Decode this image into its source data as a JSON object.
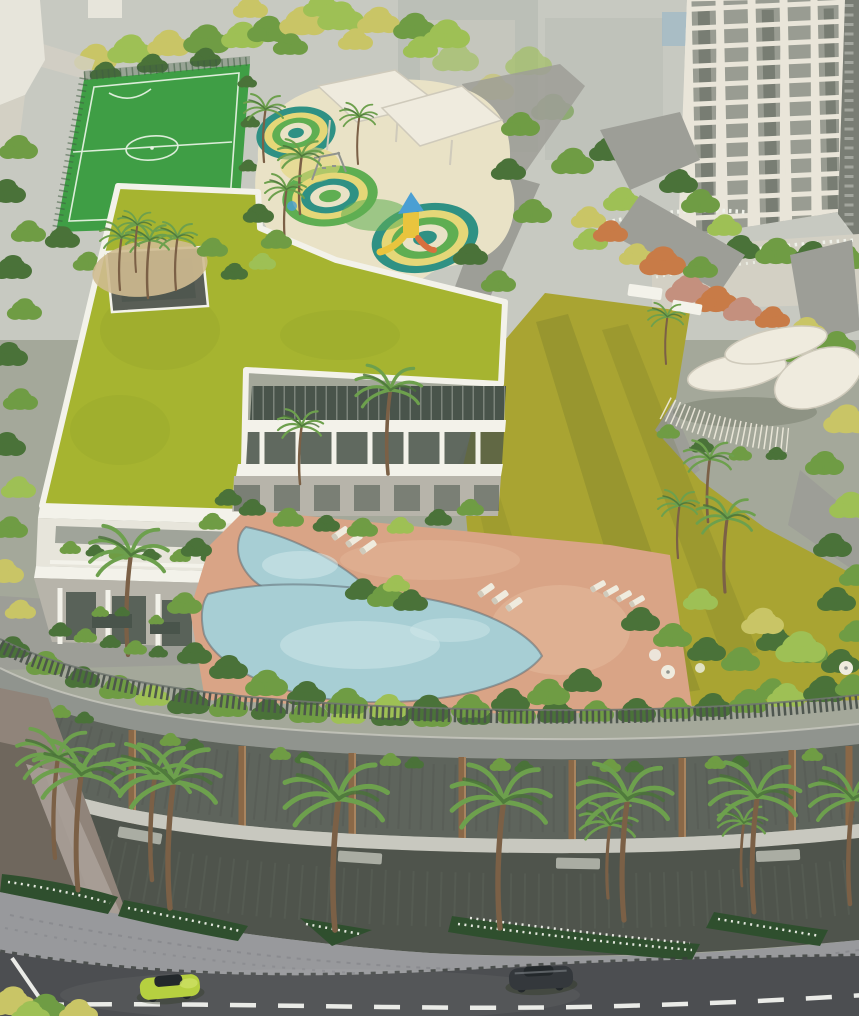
{
  "scene": {
    "title": "Aerial architectural rendering of a residential complex podium with amenities, retail promenade and street",
    "elements": [
      "hazy city backdrop",
      "residential tower",
      "football turf court",
      "kids play area with colorful rings",
      "fabric shade canopies",
      "play slide",
      "clubhouse with green roof",
      "landscaped gardens",
      "central olive lawn",
      "leaf-shaped pavilion",
      "free-form swimming pool",
      "sun loungers",
      "pool deck",
      "podium picket railing",
      "retail facade with bronze columns",
      "street palm trees",
      "white flower beds",
      "cobbled sidewalk",
      "curved road",
      "lime car",
      "dark car"
    ]
  },
  "colors": {
    "bg-haze": "#c7c9c1",
    "bg-ground": "#a4a89a",
    "ghost-building": "#b6bab3",
    "ghost-glass": "#8fb3c9",
    "tower-face": "#e9e5d9",
    "tower-shadow": "#d3d0c4",
    "tower-window": "#85897f",
    "tower-glass-dark": "#5d6459",
    "tower-side": "#797d74",
    "field-green": "#3f9e45",
    "field-line": "#eaf4e6",
    "fence-dark": "#3f5c42",
    "pg-base": "#e9e2c6",
    "pg-teal": "#2f9184",
    "pg-yellow": "#e5d778",
    "pg-green": "#5fae52",
    "canopy-white": "#efebde",
    "canopy-edge": "#cfcabb",
    "slide-blue": "#4b9fd3",
    "slide-yellow": "#e9c43e",
    "slide-orange": "#d8703f",
    "roof-green": "#a6b430",
    "roof-shade": "#7e8c22",
    "parapet-white": "#f3f2ea",
    "skylight-dark": "#595e56",
    "wall-white": "#e7e5db",
    "wall-gray": "#b7b4aa",
    "glass-dark": "#49544b",
    "lawn-olive": "#a9a432",
    "lawn-shadow": "#5c6623",
    "path-gray": "#9d9e97",
    "planter-tan": "#cfbb90",
    "deck-tan": "#d9a486",
    "deck-light": "#e6bb9e",
    "pool-water": "#a7ced4",
    "pool-light": "#d2e8ea",
    "pool-edge": "#5a646b",
    "tree-dark": "#4a7239",
    "tree-mid": "#6f9c44",
    "tree-light": "#9ec055",
    "tree-yellow": "#c9c566",
    "tree-orange": "#c87b47",
    "tree-pink": "#c4907e",
    "palm-trunk": "#7b6046",
    "palm-frond": "#6da04d",
    "railing-dark": "#4b524c",
    "rail-top": "#707770",
    "fascia-gray": "#90948e",
    "bay-dark": "#5e645c",
    "bronze": "#8a6847",
    "bronze-light": "#a8845f",
    "sill-light": "#c8c8bf",
    "ground-dark": "#4f544c",
    "sign-light": "#babdb3",
    "sidewalk-gray": "#98999c",
    "sidewalk-speckle": "#84858a",
    "curb-dark": "#393d3b",
    "road-asphalt": "#4c4e51",
    "road-line": "#eaebe7",
    "bed-green": "#2f4f2e",
    "flower-white": "#eff1e9",
    "car-lime": "#b6d040",
    "car-lime-light": "#cbdf62",
    "car-glass": "#23282b",
    "car-dark": "#34383c",
    "car-dark-light": "#73787d",
    "ramp-brown": "#90847a",
    "ramp-dark": "#6f675d",
    "ramp-light": "#aaa098",
    "shadow-dark": "#2e3620"
  }
}
